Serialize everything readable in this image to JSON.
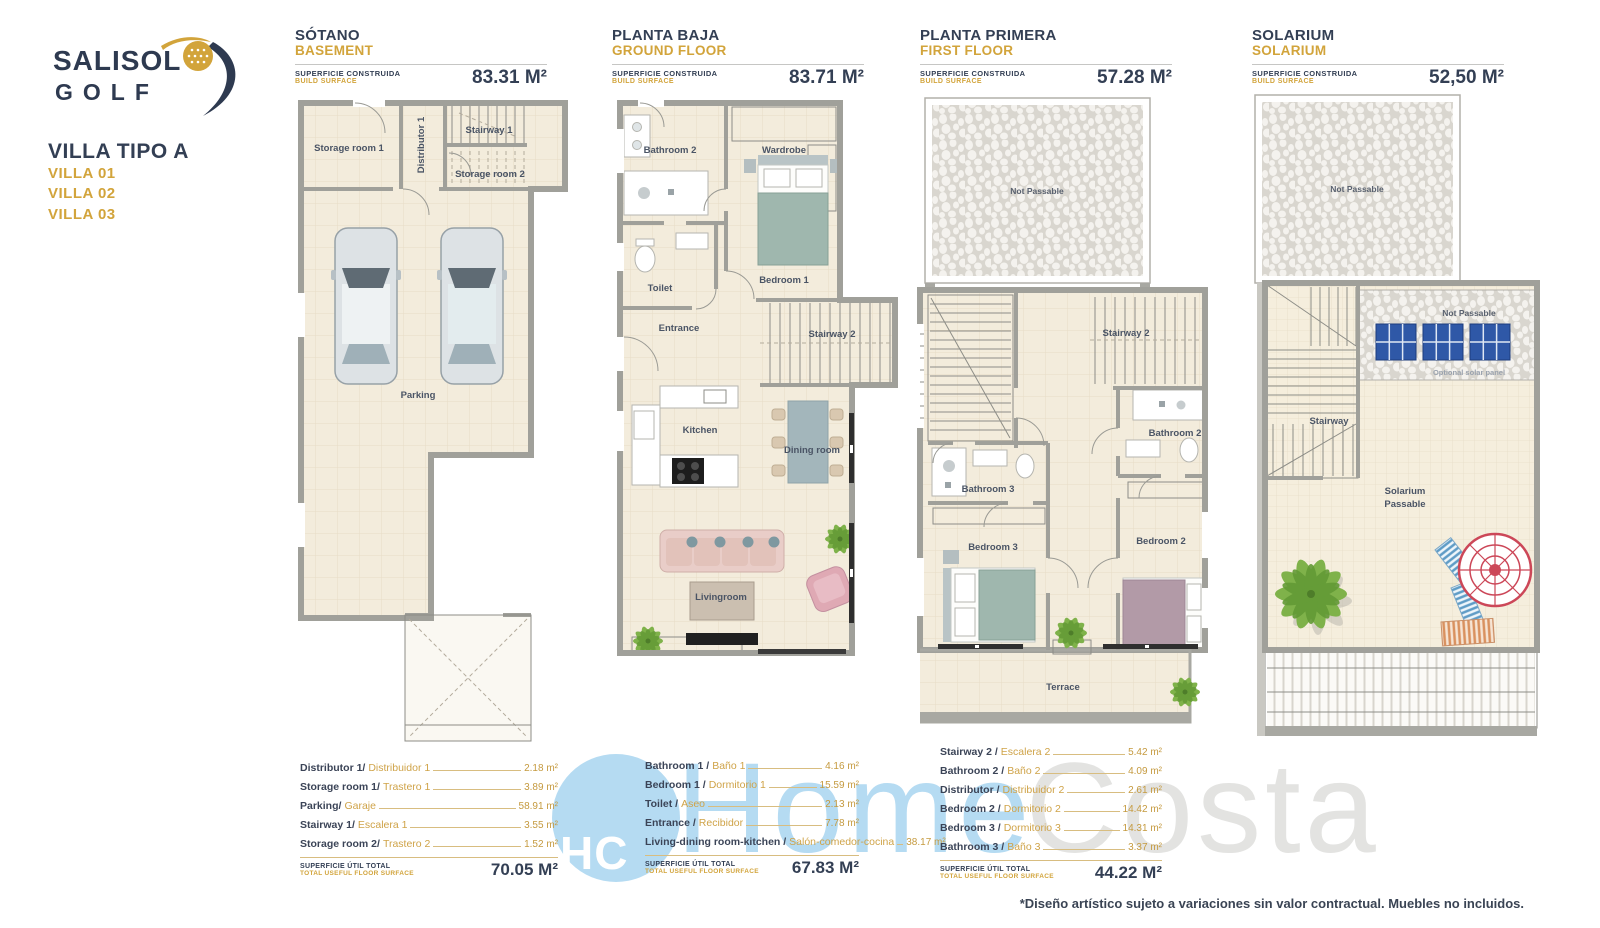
{
  "logo": {
    "line1": "SALISOL",
    "line2": "GOLF"
  },
  "villa": {
    "type_title": "VILLA TIPO A",
    "units": [
      {
        "label": "VILLA 01"
      },
      {
        "label": "VILLA 02"
      },
      {
        "label": "VILLA 03"
      }
    ]
  },
  "labels": {
    "surface_es": "SUPERFICIE CONSTRUIDA",
    "surface_en": "BUILD SURFACE",
    "total_es": "SUPERFICIE ÚTIL TOTAL",
    "total_en": "TOTAL USEFUL FLOOR SURFACE"
  },
  "plans": [
    {
      "title_es": "SÓTANO",
      "title_en": "BASEMENT",
      "area": "83.31 M²",
      "rooms": {
        "storage1": "Storage room 1",
        "distributor": "Distributor 1",
        "stairway": "Stairway 1",
        "storage2": "Storage room 2",
        "parking": "Parking"
      },
      "table": {
        "rows": [
          {
            "en": "Distributor 1/",
            "es": "Distribuidor 1",
            "value": "2.18 m²"
          },
          {
            "en": "Storage room 1/",
            "es": "Trastero 1",
            "value": "3.89 m²"
          },
          {
            "en": "Parking/",
            "es": "Garaje",
            "value": "58.91 m²"
          },
          {
            "en": "Stairway 1/",
            "es": "Escalera 1",
            "value": "3.55 m²"
          },
          {
            "en": "Storage room 2/",
            "es": "Trastero 2",
            "value": "1.52 m²"
          }
        ],
        "total": "70.05 M²"
      }
    },
    {
      "title_es": "PLANTA BAJA",
      "title_en": "GROUND FLOOR",
      "area": "83.71 M²",
      "rooms": {
        "bathroom2": "Bathroom 2",
        "wardrobe": "Wardrobe",
        "toilet": "Toilet",
        "bedroom1": "Bedroom 1",
        "entrance": "Entrance",
        "stairway2": "Stairway 2",
        "kitchen": "Kitchen",
        "dining": "Dining room",
        "living": "Livingroom"
      },
      "table": {
        "rows": [
          {
            "en": "Bathroom 1 /",
            "es": "Baño 1",
            "value": "4.16 m²"
          },
          {
            "en": "Bedroom 1 /",
            "es": "Dormitorio 1",
            "value": "15.59 m²"
          },
          {
            "en": "Toilet /",
            "es": "Aseo",
            "value": "2.13 m²"
          },
          {
            "en": "Entrance /",
            "es": "Recibidor",
            "value": "7.78 m²"
          },
          {
            "en": "Living-dining room-kitchen /",
            "es": "Salón-comedor-cocina",
            "value": "38.17 m²"
          }
        ],
        "total": "67.83 M²"
      }
    },
    {
      "title_es": "PLANTA PRIMERA",
      "title_en": "FIRST FLOOR",
      "area": "57.28 M²",
      "rooms": {
        "not_passable": "Not Passable",
        "stairway2": "Stairway 2",
        "bathroom2": "Bathroom 2",
        "bathroom3": "Bathroom 3",
        "bedroom2": "Bedroom 2",
        "bedroom3": "Bedroom 3",
        "terrace": "Terrace"
      },
      "table": {
        "rows": [
          {
            "en": "Stairway 2 /",
            "es": "Escalera 2",
            "value": "5.42 m²"
          },
          {
            "en": "Bathroom 2 /",
            "es": "Baño 2",
            "value": "4.09 m²"
          },
          {
            "en": "Distributor /",
            "es": "Distribuidor 2",
            "value": "2.61 m²"
          },
          {
            "en": "Bedroom 2 /",
            "es": "Dormitorio 2",
            "value": "14.42 m²"
          },
          {
            "en": "Bedroom 3 /",
            "es": "Dormitorio 3",
            "value": "14.31 m²"
          },
          {
            "en": "Bathroom 3 /",
            "es": "Baño 3",
            "value": "3.37 m²"
          }
        ],
        "total": "44.22 M²"
      }
    },
    {
      "title_es": "SOLARIUM",
      "title_en": "SOLARIUM",
      "area": "52,50 M²",
      "rooms": {
        "not_passable_top": "Not Passable",
        "not_passable_strip": "Not Passable",
        "optional_solar": "Optional solar panel",
        "stairway": "Stairway",
        "solarium1": "Solarium",
        "solarium2": "Passable"
      }
    }
  ],
  "watermark": {
    "initials": "HC",
    "home": "Home",
    "costa": "Costa"
  },
  "disclaimer": "*Diseño artístico sujeto a variaciones sin valor contractual. Muebles no incluidos.",
  "colors": {
    "gold": "#d2a43b",
    "navy": "#333f54",
    "wall": "#a0a09a",
    "floor": "#f3ecdc",
    "watermark_blue": "#b5dbf2",
    "watermark_gray": "#e3e3e1",
    "solar_blue": "#2f58a7"
  }
}
